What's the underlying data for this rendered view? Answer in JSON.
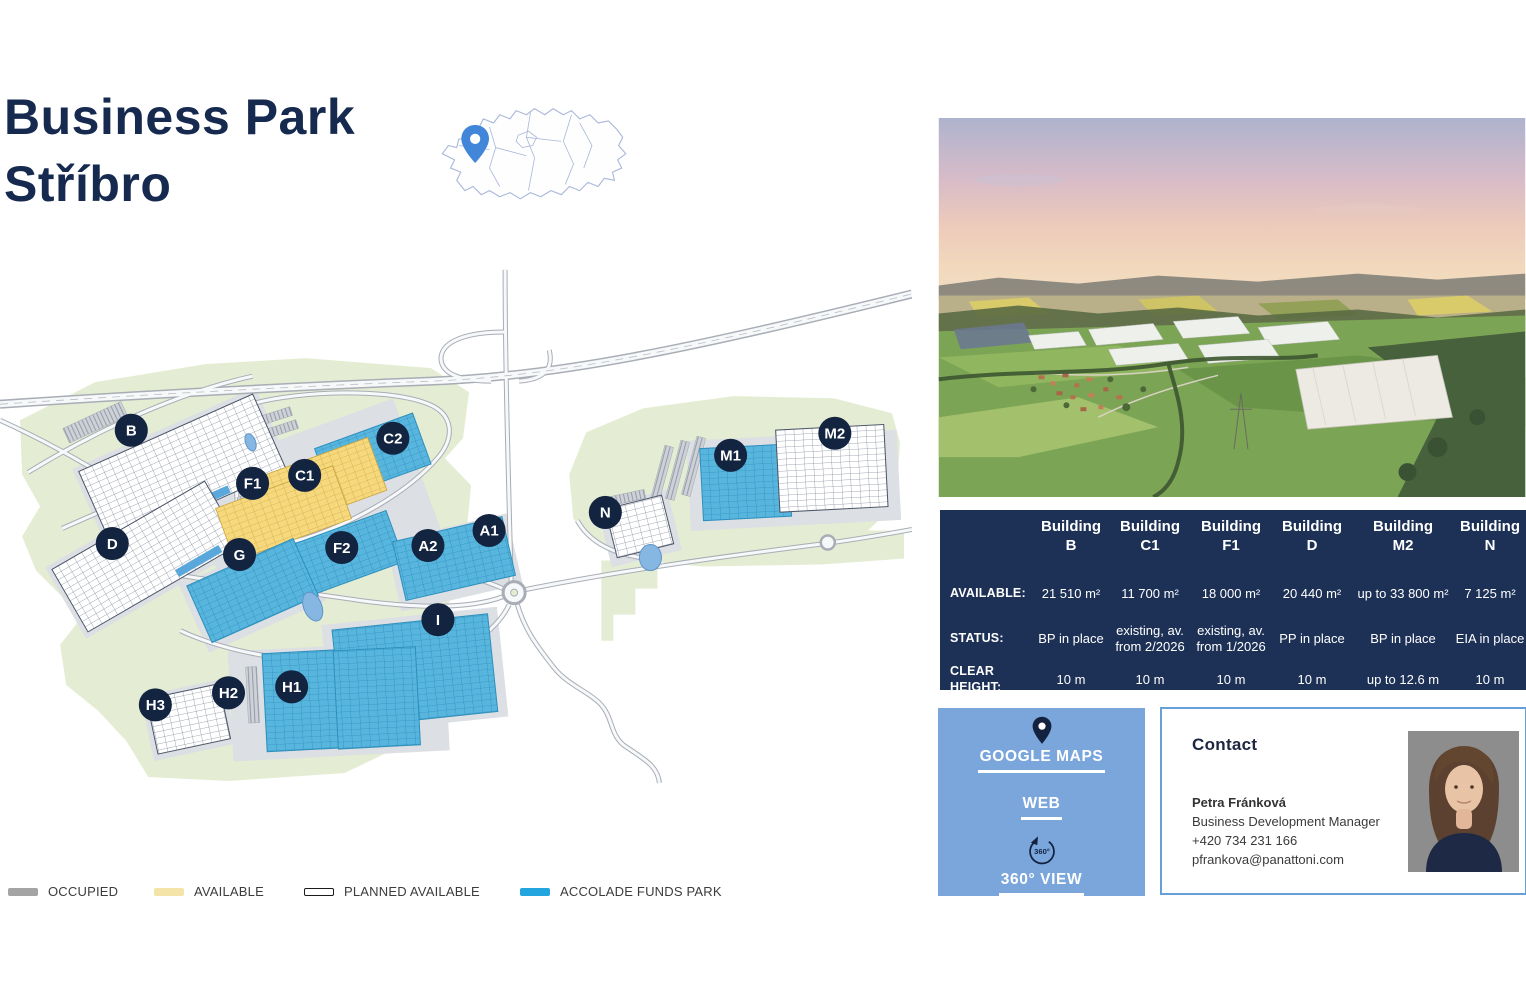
{
  "title": {
    "line1": "Business Park",
    "line2": "Stříbro"
  },
  "map": {
    "labels": [
      "B",
      "C2",
      "C1",
      "F1",
      "F2",
      "D",
      "G",
      "A2",
      "A1",
      "I",
      "H2",
      "H1",
      "H3",
      "N",
      "M1",
      "M2"
    ]
  },
  "legend": {
    "items": [
      {
        "label": "OCCUPIED"
      },
      {
        "label": "AVAILABLE"
      },
      {
        "label": "PLANNED AVAILABLE"
      },
      {
        "label": "ACCOLADE FUNDS PARK"
      }
    ]
  },
  "table": {
    "rows": {
      "available": "AVAILABLE:",
      "status": "STATUS:",
      "clear_height": "CLEAR HEIGHT:"
    },
    "columns": [
      {
        "line1": "Building",
        "code": "B",
        "available": "21 510 m²",
        "status": "BP in place",
        "clear_height": "10 m"
      },
      {
        "line1": "Building",
        "code": "C1",
        "available": "11 700 m²",
        "status": "existing, av. from 2/2026",
        "clear_height": "10 m"
      },
      {
        "line1": "Building",
        "code": "F1",
        "available": "18 000 m²",
        "status": "existing, av. from 1/2026",
        "clear_height": "10 m"
      },
      {
        "line1": "Building",
        "code": "D",
        "available": "20 440 m²",
        "status": "PP in place",
        "clear_height": "10 m"
      },
      {
        "line1": "Building",
        "code": "M2",
        "available": "up to 33 800 m²",
        "status": "BP in place",
        "clear_height": "up to 12.6 m"
      },
      {
        "line1": "Building",
        "code": "N",
        "available": "7 125 m²",
        "status": "EIA in place",
        "clear_height": "10 m"
      }
    ]
  },
  "links": {
    "google_maps": "GOOGLE MAPS",
    "web": "WEB",
    "view_360": "360° VIEW",
    "icon_360_label": "360°"
  },
  "contact": {
    "heading": "Contact",
    "name": "Petra Fránková",
    "role": "Business Development Manager",
    "phone": "+420 734 231 166",
    "email": "pfrankova@panattoni.com"
  },
  "colors": {
    "navy": "#16294f",
    "table_bg": "#1d3156",
    "accolade_blue": "#23a5df",
    "panel_blue": "#7aa6dc",
    "available_yellow": "#f6d77c",
    "occupied_gray": "#a4a4a4"
  }
}
